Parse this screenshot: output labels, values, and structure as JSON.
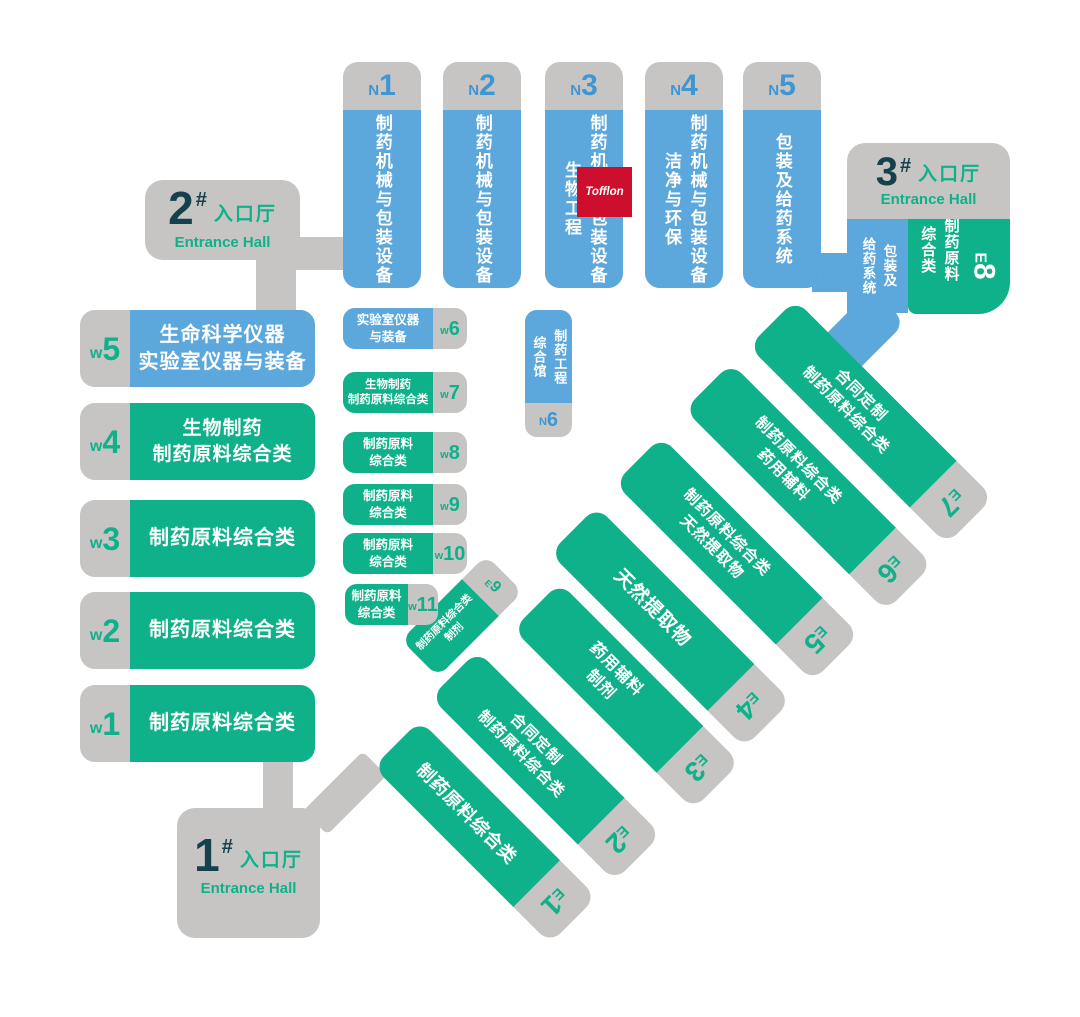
{
  "palette": {
    "blue": "#5CA7DB",
    "green": "#0EB189",
    "gray": "#C6C5C4",
    "dark_teal": "#15414D",
    "label_blue": "#3E96D3",
    "logo_red": "#CE0E2D"
  },
  "entrances": {
    "one": {
      "number": "1",
      "hash": "#",
      "cn": "入口厅",
      "en": "Entrance Hall"
    },
    "two": {
      "number": "2",
      "hash": "#",
      "cn": "入口厅",
      "en": "Entrance Hall"
    },
    "three": {
      "number": "3",
      "hash": "#",
      "cn": "入口厅",
      "en": "Entrance Hall"
    }
  },
  "halls": {
    "n1": {
      "prefix": "N",
      "digit": "1",
      "text": "制药机械与包装设备"
    },
    "n2": {
      "prefix": "N",
      "digit": "2",
      "text": "制药机械与包装设备"
    },
    "n3": {
      "prefix": "N",
      "digit": "3",
      "text": "制药机械与包装设备\n生物工程",
      "logo": "Tofflon"
    },
    "n4": {
      "prefix": "N",
      "digit": "4",
      "text": "制药机械与包装设备\n洁净与环保"
    },
    "n5": {
      "prefix": "N",
      "digit": "5",
      "text": "包装及给药系统"
    },
    "n6": {
      "prefix": "N",
      "digit": "6",
      "text": "制药工程\n综合馆"
    },
    "w1": {
      "prefix": "w",
      "digit": "1",
      "text": "制药原料综合类"
    },
    "w2": {
      "prefix": "w",
      "digit": "2",
      "text": "制药原料综合类"
    },
    "w3": {
      "prefix": "w",
      "digit": "3",
      "text": "制药原料综合类"
    },
    "w4": {
      "prefix": "w",
      "digit": "4",
      "text": "生物制药\n制药原料综合类"
    },
    "w5": {
      "prefix": "w",
      "digit": "5",
      "text": "生命科学仪器\n实验室仪器与装备"
    },
    "w6": {
      "prefix": "w",
      "digit": "6",
      "text": "实验室仪器\n与装备"
    },
    "w7": {
      "prefix": "w",
      "digit": "7",
      "text": "生物制药\n制药原料综合类"
    },
    "w8": {
      "prefix": "w",
      "digit": "8",
      "text": "制药原料\n综合类"
    },
    "w9": {
      "prefix": "w",
      "digit": "9",
      "text": "制药原料\n综合类"
    },
    "w10": {
      "prefix": "w",
      "digit": "10",
      "text": "制药原料\n综合类"
    },
    "w11": {
      "prefix": "w",
      "digit": "11",
      "text": "制药原料\n综合类"
    },
    "e1": {
      "prefix": "E",
      "digit": "1",
      "text": "制药原料综合类"
    },
    "e2": {
      "prefix": "E",
      "digit": "2",
      "text": "合同定制\n制药原料综合类"
    },
    "e3": {
      "prefix": "E",
      "digit": "3",
      "text": "药用辅料\n制剂"
    },
    "e4": {
      "prefix": "E",
      "digit": "4",
      "text": "天然提取物"
    },
    "e5": {
      "prefix": "E",
      "digit": "5",
      "text": "制药原料综合类\n天然提取物"
    },
    "e6": {
      "prefix": "E",
      "digit": "6",
      "text": "制药原料综合类\n药用辅料"
    },
    "e7": {
      "prefix": "E",
      "digit": "7",
      "text": "合同定制\n制药原料综合类"
    },
    "e8": {
      "prefix": "E",
      "digit": "8",
      "text": "制药原料\n综合类",
      "side_text": "包装及\n给药系统"
    },
    "e9": {
      "prefix": "E",
      "digit": "9",
      "text": "制药原料综合类\n制剂"
    }
  }
}
